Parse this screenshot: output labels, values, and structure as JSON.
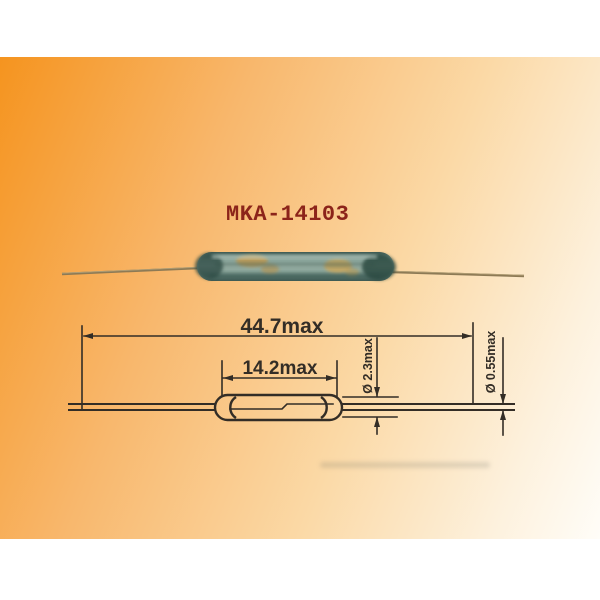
{
  "product": {
    "model": "MKA-14103"
  },
  "drawing": {
    "overall_length_label": "44.7max",
    "glass_length_label": "14.2max",
    "glass_diameter_label": "Ø 2.3max",
    "lead_diameter_label": "Ø 0.55max"
  },
  "colors": {
    "accent_orange": "#f5941f",
    "gradient_light": "#fffdf8",
    "model_text": "#8c241a",
    "drawing_line": "#332d26",
    "glass_teal": "#84a097",
    "glass_dark_end": "#2e4c45",
    "reed_amber": "#c89c4f",
    "wire_tan": "#8d7a55"
  }
}
